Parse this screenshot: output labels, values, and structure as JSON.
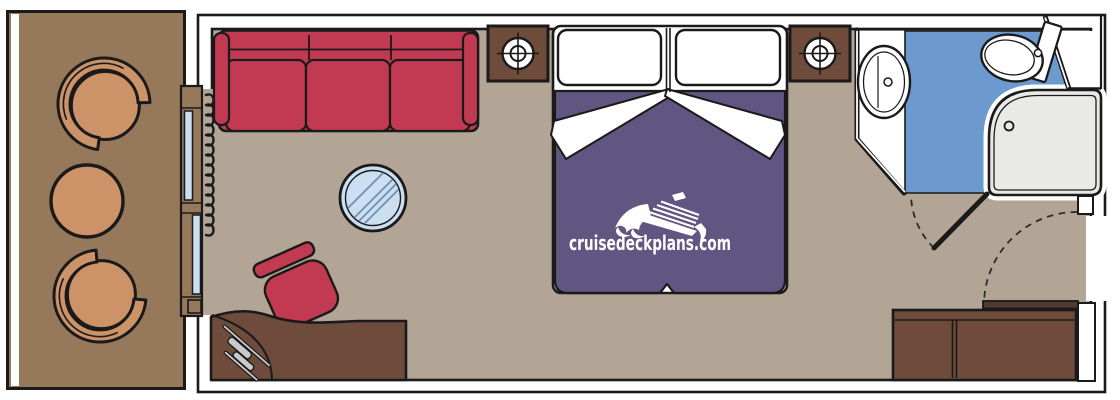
{
  "watermark": {
    "text": "cruisedeckplans.com",
    "logo": "cruise-ship-logo"
  },
  "colors": {
    "page_bg": "#FFFFFF",
    "outline_black": "#1A1A1A",
    "wall_white": "#FFFFFF",
    "deck_wood": "#96785A",
    "patio_furniture_tan": "#CC9268",
    "cabin_floor": "#B2A595",
    "dark_wood": "#6F4B3C",
    "sofa_red": "#C23A52",
    "bed_purple": "#615581",
    "bath_floor_blue": "#6C9ACE",
    "glass_blue": "#CBDFF1",
    "shower_gray": "#E9EAE8",
    "door_wood_dark": "#503B2E",
    "hairdryer_gray": "#C9C9C9",
    "table_hatch_blue": "#6F8FB0",
    "door_swing_dash": "#2B2B2B",
    "watermark_white": "#FFFFFF"
  }
}
